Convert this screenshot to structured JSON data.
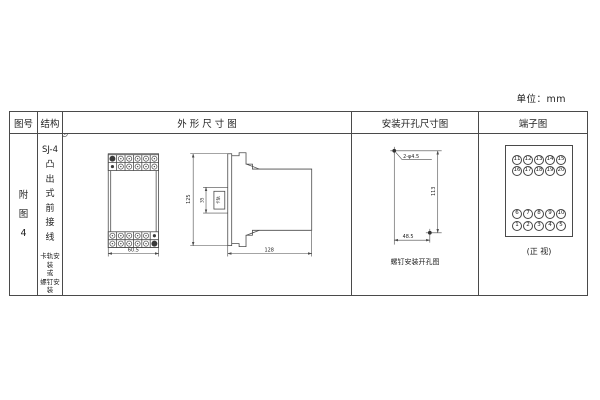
{
  "page": {
    "unit_label": "单位：mm",
    "line_color": "#4a4a4a",
    "background": "#ffffff"
  },
  "table": {
    "headers": {
      "figure_no": "图号",
      "structure": "结构",
      "outline": "外 形 尺 寸 图",
      "mounting": "安装开孔尺寸图",
      "terminal": "端子图"
    }
  },
  "figure_no": {
    "chars": [
      "附",
      "图",
      "4"
    ]
  },
  "structure": {
    "model": "SJ-4",
    "type_chars": [
      "凸",
      "出",
      "式",
      "前",
      "接",
      "线"
    ],
    "mount_lines": [
      "卡轨安装",
      "或",
      "螺钉安装"
    ]
  },
  "outline": {
    "front_width": "60.5",
    "height": "125",
    "rail_dim": "35",
    "rail_label": "卡轨",
    "depth": "128"
  },
  "mounting": {
    "hole_label": "2-φ4.5",
    "vertical_dim": "113",
    "horizontal_dim": "48.5",
    "caption": "螺钉安装开孔图"
  },
  "terminal": {
    "top_rows": [
      [
        "11",
        "12",
        "13",
        "14",
        "15"
      ],
      [
        "16",
        "17",
        "18",
        "19",
        "20"
      ]
    ],
    "bottom_rows": [
      [
        "6",
        "7",
        "8",
        "9",
        "10"
      ],
      [
        "1",
        "2",
        "3",
        "4",
        "5"
      ]
    ],
    "caption": "(正 视)"
  }
}
